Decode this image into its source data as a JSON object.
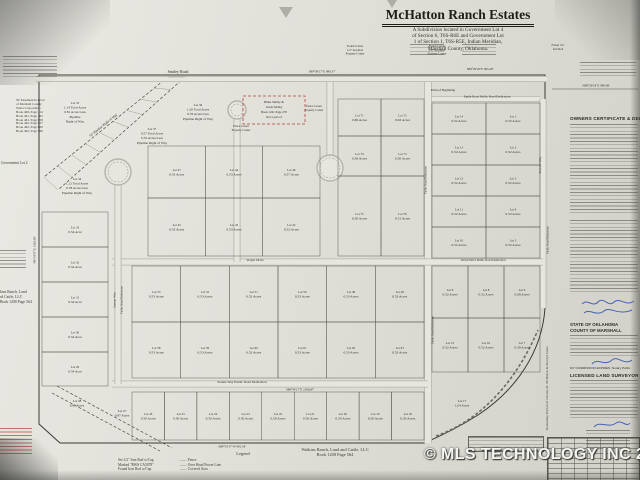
{
  "photo": {
    "watermark": "© MLS TECHNOLOGY INC 2026"
  },
  "title_block": {
    "title": "McHatton Ranch Estates",
    "subtitle_lines": [
      "A Subdivision located in Government Lot 4",
      "of Section 6, T6S-R6E and Government Lot",
      "1 of Section 1, T6S-R5E, Indian Meridian,",
      "Marshall County, Oklahoma."
    ]
  },
  "margins": {
    "government_lot": "Government Lot 2",
    "easement_lines": [
      "50' Easement in favor",
      "of Marshall County",
      "Water Corporation",
      "Book 460, Page 114",
      "Book 461, Page 162",
      "Book 461, Page 658",
      "Book 462, Page 657",
      "Book 462, Page 660",
      "Book 462, Page 566"
    ],
    "watkins_west_lines": [
      "kins Ranch, Land",
      "rd Cattle, LLC",
      "Book 1208 Page 564"
    ],
    "watkins_bottom_lines": [
      "Watkins Ranch, Land and Cattle, LLC",
      "Book 1208 Page 564"
    ]
  },
  "legend": {
    "heading": "Legend",
    "left": [
      "Set 1/2\" Iron Rod w/Cap",
      "Marked \"RWS CA5078\"",
      "Found Iron Rod w/Cap"
    ],
    "right": [
      "Fence",
      "Over Head Power Line",
      "Covered Area"
    ]
  },
  "right_panel": {
    "owners_heading": "OWNERS CERTIFICATE & DEDICATION",
    "state": "STATE OF OKLAHOMA",
    "county": "COUNTY OF MARSHALL",
    "commission": "MY COMMISSION EXPIRES:",
    "notary": "Notary Public",
    "surveyor_heading": "LICENSED LAND SURVEYOR",
    "side_text": "Remaining Portion of Charles M. McHatton & Marilyn Jones"
  },
  "map": {
    "point_of_beginning": "Point of Beginning",
    "pipeline_label": "50' Pipeline Right of Way",
    "exclusion": {
      "x": 243,
      "y": 96,
      "w": 62,
      "h": 28,
      "lines": [
        "Blake Smiley &",
        "Linda Smiley",
        "Book 1241  Page 270",
        "Not a part of"
      ]
    },
    "roads": [
      {
        "type": "line",
        "x1": 36,
        "y1": 79,
        "x2": 547,
        "y2": 79,
        "w": 6
      },
      {
        "type": "line",
        "x1": 432,
        "y1": 99,
        "x2": 540,
        "y2": 99,
        "w": 6
      },
      {
        "type": "line",
        "x1": 428,
        "y1": 82,
        "x2": 428,
        "y2": 443,
        "w": 8
      },
      {
        "type": "line",
        "x1": 543,
        "y1": 99,
        "x2": 543,
        "y2": 308,
        "w": 7
      },
      {
        "type": "line",
        "x1": 112,
        "y1": 262,
        "x2": 543,
        "y2": 262,
        "w": 7
      },
      {
        "type": "line",
        "x1": 112,
        "y1": 384,
        "x2": 428,
        "y2": 384,
        "w": 7
      },
      {
        "type": "line",
        "x1": 118,
        "y1": 178,
        "x2": 118,
        "y2": 384,
        "w": 7
      },
      {
        "type": "line",
        "x1": 237,
        "y1": 114,
        "x2": 237,
        "y2": 262,
        "w": 7
      },
      {
        "type": "line",
        "x1": 330,
        "y1": 82,
        "x2": 330,
        "y2": 157,
        "w": 7
      },
      {
        "type": "circ",
        "cx": 118,
        "cy": 172,
        "r": 13
      },
      {
        "type": "circ",
        "cx": 237,
        "cy": 110,
        "r": 9
      },
      {
        "type": "circ",
        "cx": 330,
        "cy": 168,
        "r": 13
      }
    ],
    "lot_rows": [
      {
        "x": 432,
        "y": 103,
        "w": 108,
        "h": 31,
        "lots": [
          [
            "Lot 14",
            "0.52 Acres"
          ],
          [
            "Lot 1",
            "0.52 Acres"
          ]
        ]
      },
      {
        "x": 432,
        "y": 134,
        "w": 108,
        "h": 31,
        "lots": [
          [
            "Lot 13",
            "0.52 Acres"
          ],
          [
            "Lot 2",
            "0.52 Acres"
          ]
        ]
      },
      {
        "x": 432,
        "y": 165,
        "w": 108,
        "h": 31,
        "lots": [
          [
            "Lot 12",
            "0.52 Acres"
          ],
          [
            "Lot 3",
            "0.52 Acres"
          ]
        ]
      },
      {
        "x": 432,
        "y": 196,
        "w": 108,
        "h": 31,
        "lots": [
          [
            "Lot 11",
            "0.52 Acres"
          ],
          [
            "Lot 4",
            "0.52 Acres"
          ]
        ]
      },
      {
        "x": 432,
        "y": 227,
        "w": 108,
        "h": 31,
        "lots": [
          [
            "Lot 10",
            "0.52 Acres"
          ],
          [
            "Lot 5",
            "0.52 Acres"
          ]
        ]
      },
      {
        "x": 432,
        "y": 266,
        "w": 108,
        "h": 52,
        "lots": [
          [
            "Lot 9",
            "0.52 Acres"
          ],
          [
            "Lot 8",
            "0.52 Acres"
          ],
          [
            "Lot 6",
            "0.69 Acres"
          ]
        ]
      },
      {
        "x": 432,
        "y": 318,
        "w": 108,
        "h": 54,
        "lots": [
          [
            "Lot 15",
            "0.52 Acres"
          ],
          [
            "Lot 16",
            "0.52 Acres"
          ],
          [
            "Lot 7",
            "0.58 Acres"
          ]
        ]
      },
      {
        "x": 148,
        "y": 146,
        "w": 172,
        "h": 52,
        "lots": [
          [
            "Lot 47",
            "0.53 Acres"
          ],
          [
            "Lot 44",
            "0.53 Acres"
          ],
          [
            "Lot 46",
            "0.57 Acres"
          ]
        ]
      },
      {
        "x": 148,
        "y": 198,
        "w": 172,
        "h": 58,
        "lots": [
          [
            "Lot 45",
            "0.53 Acres"
          ],
          [
            "Lot 43",
            "0.53 Acres"
          ],
          [
            "Lot 42",
            "0.52 Acres"
          ]
        ]
      },
      {
        "x": 338,
        "y": 99,
        "w": 86,
        "h": 37,
        "lots": [
          [
            "Lot 71",
            "0.69 Acres"
          ],
          [
            "Lot 72",
            "0.63 Acres"
          ]
        ]
      },
      {
        "x": 338,
        "y": 136,
        "w": 86,
        "h": 40,
        "lots": [
          [
            "Lot 74",
            "0.56 Acres"
          ],
          [
            "Lot 73",
            "0.50 Acres"
          ]
        ]
      },
      {
        "x": 338,
        "y": 176,
        "w": 86,
        "h": 80,
        "lots": [
          [
            "Lot 75",
            "0.50 Acres"
          ],
          [
            "Lot 76",
            "0.51 Acres"
          ]
        ]
      },
      {
        "x": 132,
        "y": 266,
        "w": 292,
        "h": 56,
        "lots": [
          [
            "Lot 53",
            "0.53 Acres"
          ],
          [
            "Lot 52",
            "0.53 Acres"
          ],
          [
            "Lot 51",
            "0.53 Acres"
          ],
          [
            "Lot 50",
            "0.53 Acres"
          ],
          [
            "Lot 49",
            "0.53 Acres"
          ],
          [
            "Lot 48",
            "0.53 Acres"
          ]
        ]
      },
      {
        "x": 132,
        "y": 322,
        "w": 292,
        "h": 56,
        "lots": [
          [
            "Lot 58",
            "0.53 Acres"
          ],
          [
            "Lot 59",
            "0.53 Acres"
          ],
          [
            "Lot 60",
            "0.53 Acres"
          ],
          [
            "Lot 61",
            "0.53 Acres"
          ],
          [
            "Lot 62",
            "0.53 Acres"
          ],
          [
            "Lot 63",
            "0.53 Acres"
          ]
        ]
      },
      {
        "x": 132,
        "y": 392,
        "w": 292,
        "h": 48,
        "lots": [
          [
            "Lot 26",
            "0.50 Acres"
          ],
          [
            "Lot 25",
            "0.50 Acres"
          ],
          [
            "Lot 24",
            "0.50 Acres"
          ],
          [
            "Lot 23",
            "0.50 Acres"
          ],
          [
            "Lot 22",
            "0.50 Acres"
          ],
          [
            "Lot 21",
            "0.50 Acres"
          ],
          [
            "Lot 20",
            "0.50 Acres"
          ],
          [
            "Lot 19",
            "0.50 Acres"
          ],
          [
            "Lot 18",
            "0.50 Acres"
          ]
        ]
      },
      {
        "x": 42,
        "y": 212,
        "w": 66,
        "h": 35,
        "lots": [
          [
            "Lot 33",
            "0.54 Acre"
          ]
        ]
      },
      {
        "x": 42,
        "y": 247,
        "w": 66,
        "h": 35,
        "lots": [
          [
            "Lot 32",
            "0.54 Acre"
          ]
        ]
      },
      {
        "x": 42,
        "y": 282,
        "w": 66,
        "h": 35,
        "lots": [
          [
            "Lot 31",
            "0.54 Acre"
          ]
        ]
      },
      {
        "x": 42,
        "y": 317,
        "w": 66,
        "h": 35,
        "lots": [
          [
            "Lot 30",
            "0.54 Acre"
          ]
        ]
      },
      {
        "x": 42,
        "y": 352,
        "w": 66,
        "h": 34,
        "lots": [
          [
            "Lot 29",
            "0.54 Acre"
          ]
        ]
      }
    ],
    "big_lots": [
      {
        "x": 75,
        "y": 104,
        "lines": [
          "Lot 35",
          "1.14 Total Acres",
          "0.81 Acres Less",
          "Pipeline",
          "Right of Way"
        ]
      },
      {
        "x": 198,
        "y": 106,
        "lines": [
          "Lot 36",
          "1.20 Total Acres",
          "0.76 Acres Less",
          "Pipeline Right of Way"
        ]
      },
      {
        "x": 152,
        "y": 130,
        "lines": [
          "Lot 37",
          "0.57 Total Acres",
          "0.55 Acres Less",
          "Pipeline Right of Way"
        ]
      },
      {
        "x": 77,
        "y": 180,
        "lines": [
          "Lot 34",
          "1.12 Total Acres",
          "0.78 Acres Less",
          "Pipeline Right of Way"
        ]
      },
      {
        "x": 77,
        "y": 402,
        "lines": [
          "Lot 28",
          "0.81 Acres"
        ]
      },
      {
        "x": 122,
        "y": 412,
        "lines": [
          "Lot 27",
          "0.87 Acres"
        ]
      },
      {
        "x": 462,
        "y": 402,
        "lines": [
          "Lot 17",
          "1.04 Acres"
        ]
      }
    ],
    "labels": [
      {
        "t": "Smiley Road",
        "x": 178,
        "y": 73,
        "r": 0,
        "s": 4
      },
      {
        "t": "S89°58'17\"E  990.37'",
        "x": 322,
        "y": 72.5,
        "r": 0,
        "s": 3.2,
        "c": "dim"
      },
      {
        "t": "S89°29'18\"E  995.28'",
        "x": 480,
        "y": 70,
        "r": 0,
        "s": 3.2,
        "c": "dim"
      },
      {
        "t": "N89°29'18\"E  990.08'",
        "x": 596,
        "y": 86.5,
        "r": 0,
        "s": 3.2,
        "c": "dim"
      },
      {
        "t": "Emily Road    Public Road Dedication",
        "x": 487,
        "y": 97.6,
        "r": 0,
        "s": 3.2
      },
      {
        "t": "Point of Beginning",
        "x": 443,
        "y": 91,
        "r": 0,
        "s": 3.2,
        "c": "dim"
      },
      {
        "t": "Verlyn Drive",
        "x": 255,
        "y": 260.8,
        "r": 0,
        "s": 3.4
      },
      {
        "t": "Verlyn Drive    Public Road Dedication",
        "x": 483,
        "y": 260.8,
        "r": 0,
        "s": 3
      },
      {
        "t": "Serene Way      Public Road Dedication",
        "x": 242,
        "y": 382.8,
        "r": 0,
        "s": 3.4
      },
      {
        "t": "S89°54'17\"E  1056.87'",
        "x": 300,
        "y": 390.6,
        "r": 0,
        "s": 3.2,
        "c": "dim"
      },
      {
        "t": "S89°54'17\"W  991.54'",
        "x": 232,
        "y": 447.5,
        "r": 0,
        "s": 3.2,
        "c": "dim"
      },
      {
        "t": "Serene Way",
        "x": 115.6,
        "y": 300,
        "r": -90,
        "s": 3.4
      },
      {
        "t": "Public Road Dedication",
        "x": 122.6,
        "y": 300,
        "r": -90,
        "s": 2.9
      },
      {
        "t": "Public Road Dedication",
        "x": 426.4,
        "y": 180,
        "r": -90,
        "s": 2.9
      },
      {
        "t": "Public Road Dedication",
        "x": 433.6,
        "y": 330,
        "r": -90,
        "s": 2.9
      },
      {
        "t": "Service Way",
        "x": 541,
        "y": 165,
        "r": -90,
        "s": 3.4
      },
      {
        "t": "Public Road Dedication",
        "x": 548.5,
        "y": 240,
        "r": -90,
        "s": 2.9
      },
      {
        "t": "50' Pipeline Right of Way",
        "x": 104,
        "y": 126,
        "r": -38.8,
        "s": 3.4,
        "c": "dim"
      },
      {
        "t": "N0°14'37\"E  1320.00'",
        "x": 35.5,
        "y": 250,
        "r": -90,
        "s": 3.2,
        "c": "dim"
      }
    ],
    "red_notes": [
      {
        "x": 355,
        "y": 47,
        "lines": [
          "Found Corner",
          "1/2\" Iron Rod",
          "Property Corner"
        ]
      },
      {
        "x": 437,
        "y": 47,
        "lines": [
          "Found Corner",
          "1/2\" Iron Rod",
          "Property Corner"
        ]
      },
      {
        "x": 241,
        "y": 127,
        "lines": [
          "Fence Corner",
          "Property Corner"
        ]
      },
      {
        "x": 314,
        "y": 107,
        "lines": [
          "Fence Corner",
          "Property Corner"
        ]
      },
      {
        "x": 558,
        "y": 46,
        "lines": [
          "Found 1/2\"",
          "Iron Rod"
        ]
      }
    ]
  }
}
